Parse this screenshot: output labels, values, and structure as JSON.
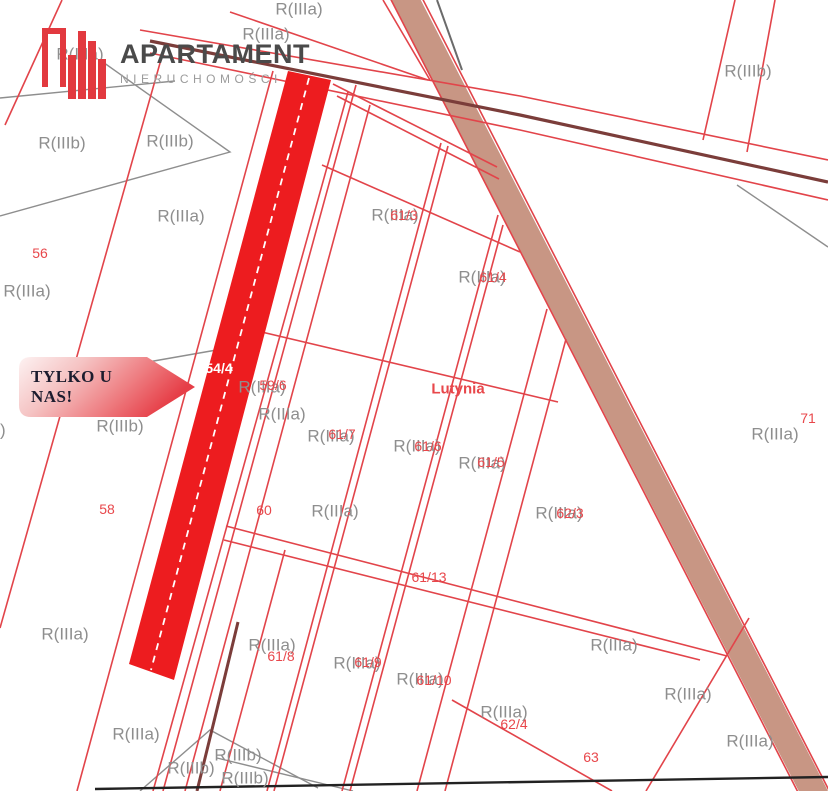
{
  "brand": {
    "name": "APARTAMENT",
    "subtitle": "NIERUCHOMOŚCI"
  },
  "badge": {
    "text": "TYLKO U NAS!"
  },
  "colors": {
    "c-highlight": "#ed1c1f",
    "c-line": "#e2444a",
    "c-road": "#c89684",
    "c-class": "#8e8e8e",
    "c-parcelnum": "#e8474b",
    "c-maroon": "#7b3d3a",
    "c-brand-dark": "#4a4a4a",
    "c-brand-gray": "#9b9b9b",
    "c-brand-red": "#e2393f"
  },
  "map": {
    "labels": [
      {
        "text": "R(IIIa)",
        "x": 299,
        "y": 9,
        "kind": "class"
      },
      {
        "text": "R(IIIa)",
        "x": 266,
        "y": 34,
        "kind": "class"
      },
      {
        "text": "R(IIIa)",
        "x": 80,
        "y": 54,
        "kind": "class"
      },
      {
        "text": "R(IIIb)",
        "x": 62,
        "y": 143,
        "kind": "class"
      },
      {
        "text": "R(IIIb)",
        "x": 170,
        "y": 141,
        "kind": "class"
      },
      {
        "text": "R(IIIb)",
        "x": 748,
        "y": 71,
        "kind": "class"
      },
      {
        "text": "R(IIIa)",
        "x": 181,
        "y": 216,
        "kind": "class"
      },
      {
        "text": "R(IIIa)",
        "x": 27,
        "y": 291,
        "kind": "class"
      },
      {
        "text": "R(IIIa)",
        "x": 395,
        "y": 215,
        "kind": "class"
      },
      {
        "text": "R(IIIa)",
        "x": 482,
        "y": 277,
        "kind": "class"
      },
      {
        "text": "R(IIIa)",
        "x": 262,
        "y": 387,
        "kind": "class"
      },
      {
        "text": "R(IIIb)",
        "x": -18,
        "y": 430,
        "kind": "class"
      },
      {
        "text": "R(IIIb)",
        "x": 120,
        "y": 426,
        "kind": "class"
      },
      {
        "text": "R(IIIa)",
        "x": 282,
        "y": 414,
        "kind": "class"
      },
      {
        "text": "R(IIIa)",
        "x": 331,
        "y": 436,
        "kind": "class"
      },
      {
        "text": "R(IIIa)",
        "x": 417,
        "y": 446,
        "kind": "class"
      },
      {
        "text": "R(IIIa)",
        "x": 482,
        "y": 463,
        "kind": "class"
      },
      {
        "text": "R(IIIa)",
        "x": 559,
        "y": 513,
        "kind": "class"
      },
      {
        "text": "R(IIIa)",
        "x": 335,
        "y": 511,
        "kind": "class"
      },
      {
        "text": "R(IIIa)",
        "x": 775,
        "y": 434,
        "kind": "class"
      },
      {
        "text": "R(IIIa)",
        "x": 65,
        "y": 634,
        "kind": "class"
      },
      {
        "text": "R(IIIa)",
        "x": 272,
        "y": 645,
        "kind": "class"
      },
      {
        "text": "R(IIIa)",
        "x": 357,
        "y": 663,
        "kind": "class"
      },
      {
        "text": "R(IIIa)",
        "x": 420,
        "y": 679,
        "kind": "class"
      },
      {
        "text": "R(IIIa)",
        "x": 504,
        "y": 712,
        "kind": "class"
      },
      {
        "text": "R(IIIa)",
        "x": 614,
        "y": 645,
        "kind": "class"
      },
      {
        "text": "R(IIIa)",
        "x": 688,
        "y": 694,
        "kind": "class"
      },
      {
        "text": "R(IIIa)",
        "x": 750,
        "y": 741,
        "kind": "class"
      },
      {
        "text": "R(IIIa)",
        "x": 136,
        "y": 734,
        "kind": "class"
      },
      {
        "text": "R(IIIb)",
        "x": 238,
        "y": 755,
        "kind": "class"
      },
      {
        "text": "R(IIIb)",
        "x": 191,
        "y": 768,
        "kind": "class"
      },
      {
        "text": "R(IIIb)",
        "x": 245,
        "y": 778,
        "kind": "class"
      },
      {
        "text": "56",
        "x": 40,
        "y": 253,
        "kind": "parcel"
      },
      {
        "text": "58",
        "x": 107,
        "y": 509,
        "kind": "parcel"
      },
      {
        "text": "60",
        "x": 264,
        "y": 510,
        "kind": "parcel"
      },
      {
        "text": "59/6",
        "x": 273,
        "y": 385,
        "kind": "parcel"
      },
      {
        "text": "61/3",
        "x": 404,
        "y": 215,
        "kind": "parcel"
      },
      {
        "text": "61/4",
        "x": 493,
        "y": 277,
        "kind": "parcel"
      },
      {
        "text": "61/5",
        "x": 491,
        "y": 462,
        "kind": "parcel"
      },
      {
        "text": "61/6",
        "x": 428,
        "y": 446,
        "kind": "parcel"
      },
      {
        "text": "61/7",
        "x": 342,
        "y": 434,
        "kind": "parcel"
      },
      {
        "text": "61/8",
        "x": 281,
        "y": 656,
        "kind": "parcel"
      },
      {
        "text": "61/9",
        "x": 368,
        "y": 662,
        "kind": "parcel"
      },
      {
        "text": "61/10",
        "x": 434,
        "y": 680,
        "kind": "parcel"
      },
      {
        "text": "61/13",
        "x": 429,
        "y": 577,
        "kind": "parcel"
      },
      {
        "text": "62/3",
        "x": 570,
        "y": 513,
        "kind": "parcel"
      },
      {
        "text": "62/4",
        "x": 514,
        "y": 724,
        "kind": "parcel"
      },
      {
        "text": "63",
        "x": 591,
        "y": 757,
        "kind": "parcel"
      },
      {
        "text": "71",
        "x": 808,
        "y": 418,
        "kind": "parcel"
      },
      {
        "text": "Lutynia",
        "x": 458,
        "y": 389,
        "kind": "place"
      },
      {
        "text": "54/4",
        "x": 219,
        "y": 368,
        "kind": "highlight"
      }
    ]
  }
}
